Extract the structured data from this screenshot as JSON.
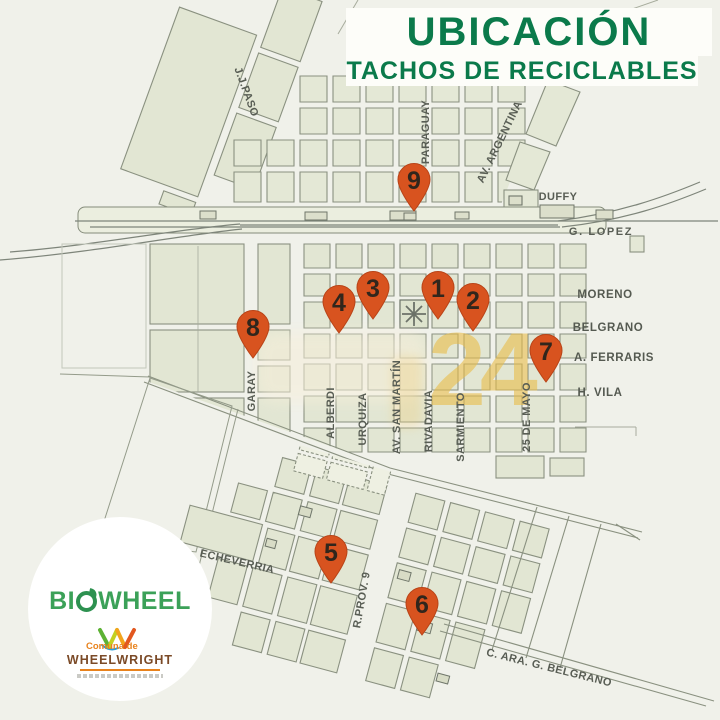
{
  "header": {
    "title": "UBICACIÓN",
    "subtitle": "TACHOS DE RECICLABLES"
  },
  "map": {
    "street_labels": [
      {
        "text": "J.J.PASO"
      },
      {
        "text": "PARAGUAY"
      },
      {
        "text": "AV. ARGENTINA"
      },
      {
        "text": "DUFFY"
      },
      {
        "text": "G. LOPEZ"
      },
      {
        "text": "MORENO"
      },
      {
        "text": "BELGRANO"
      },
      {
        "text": "A. FERRARIS"
      },
      {
        "text": "H. VILA"
      },
      {
        "text": "GARAY"
      },
      {
        "text": "ALBERDI"
      },
      {
        "text": "URQUIZA"
      },
      {
        "text": "AV. SAN MARTÍN"
      },
      {
        "text": "RIVADAVIA"
      },
      {
        "text": "SARMIENTO"
      },
      {
        "text": "25 DE MAYO"
      },
      {
        "text": "ECHEVERRIA"
      },
      {
        "text": "R.PROV. 9"
      },
      {
        "text": "C. ARA. G. BELGRANO"
      }
    ],
    "markers": [
      {
        "number": "1"
      },
      {
        "number": "2"
      },
      {
        "number": "3"
      },
      {
        "number": "4"
      },
      {
        "number": "5"
      },
      {
        "number": "6"
      },
      {
        "number": "7"
      },
      {
        "number": "8"
      },
      {
        "number": "9"
      }
    ],
    "marker_color": "#d8531f",
    "watermark": {
      "text": "24",
      "color": "#e9bd4a"
    }
  },
  "logo": {
    "brand": "BIOWHEEL",
    "brand_prefix": "BI",
    "brand_suffix": "WHEEL",
    "org_small": "Comuna de",
    "org_name": "WHEELWRIGHT"
  },
  "colors": {
    "title_green": "#0b7a4b",
    "block_fill": "#e2e6d3",
    "block_stroke": "#8a9180",
    "background": "#f0f1ea"
  }
}
